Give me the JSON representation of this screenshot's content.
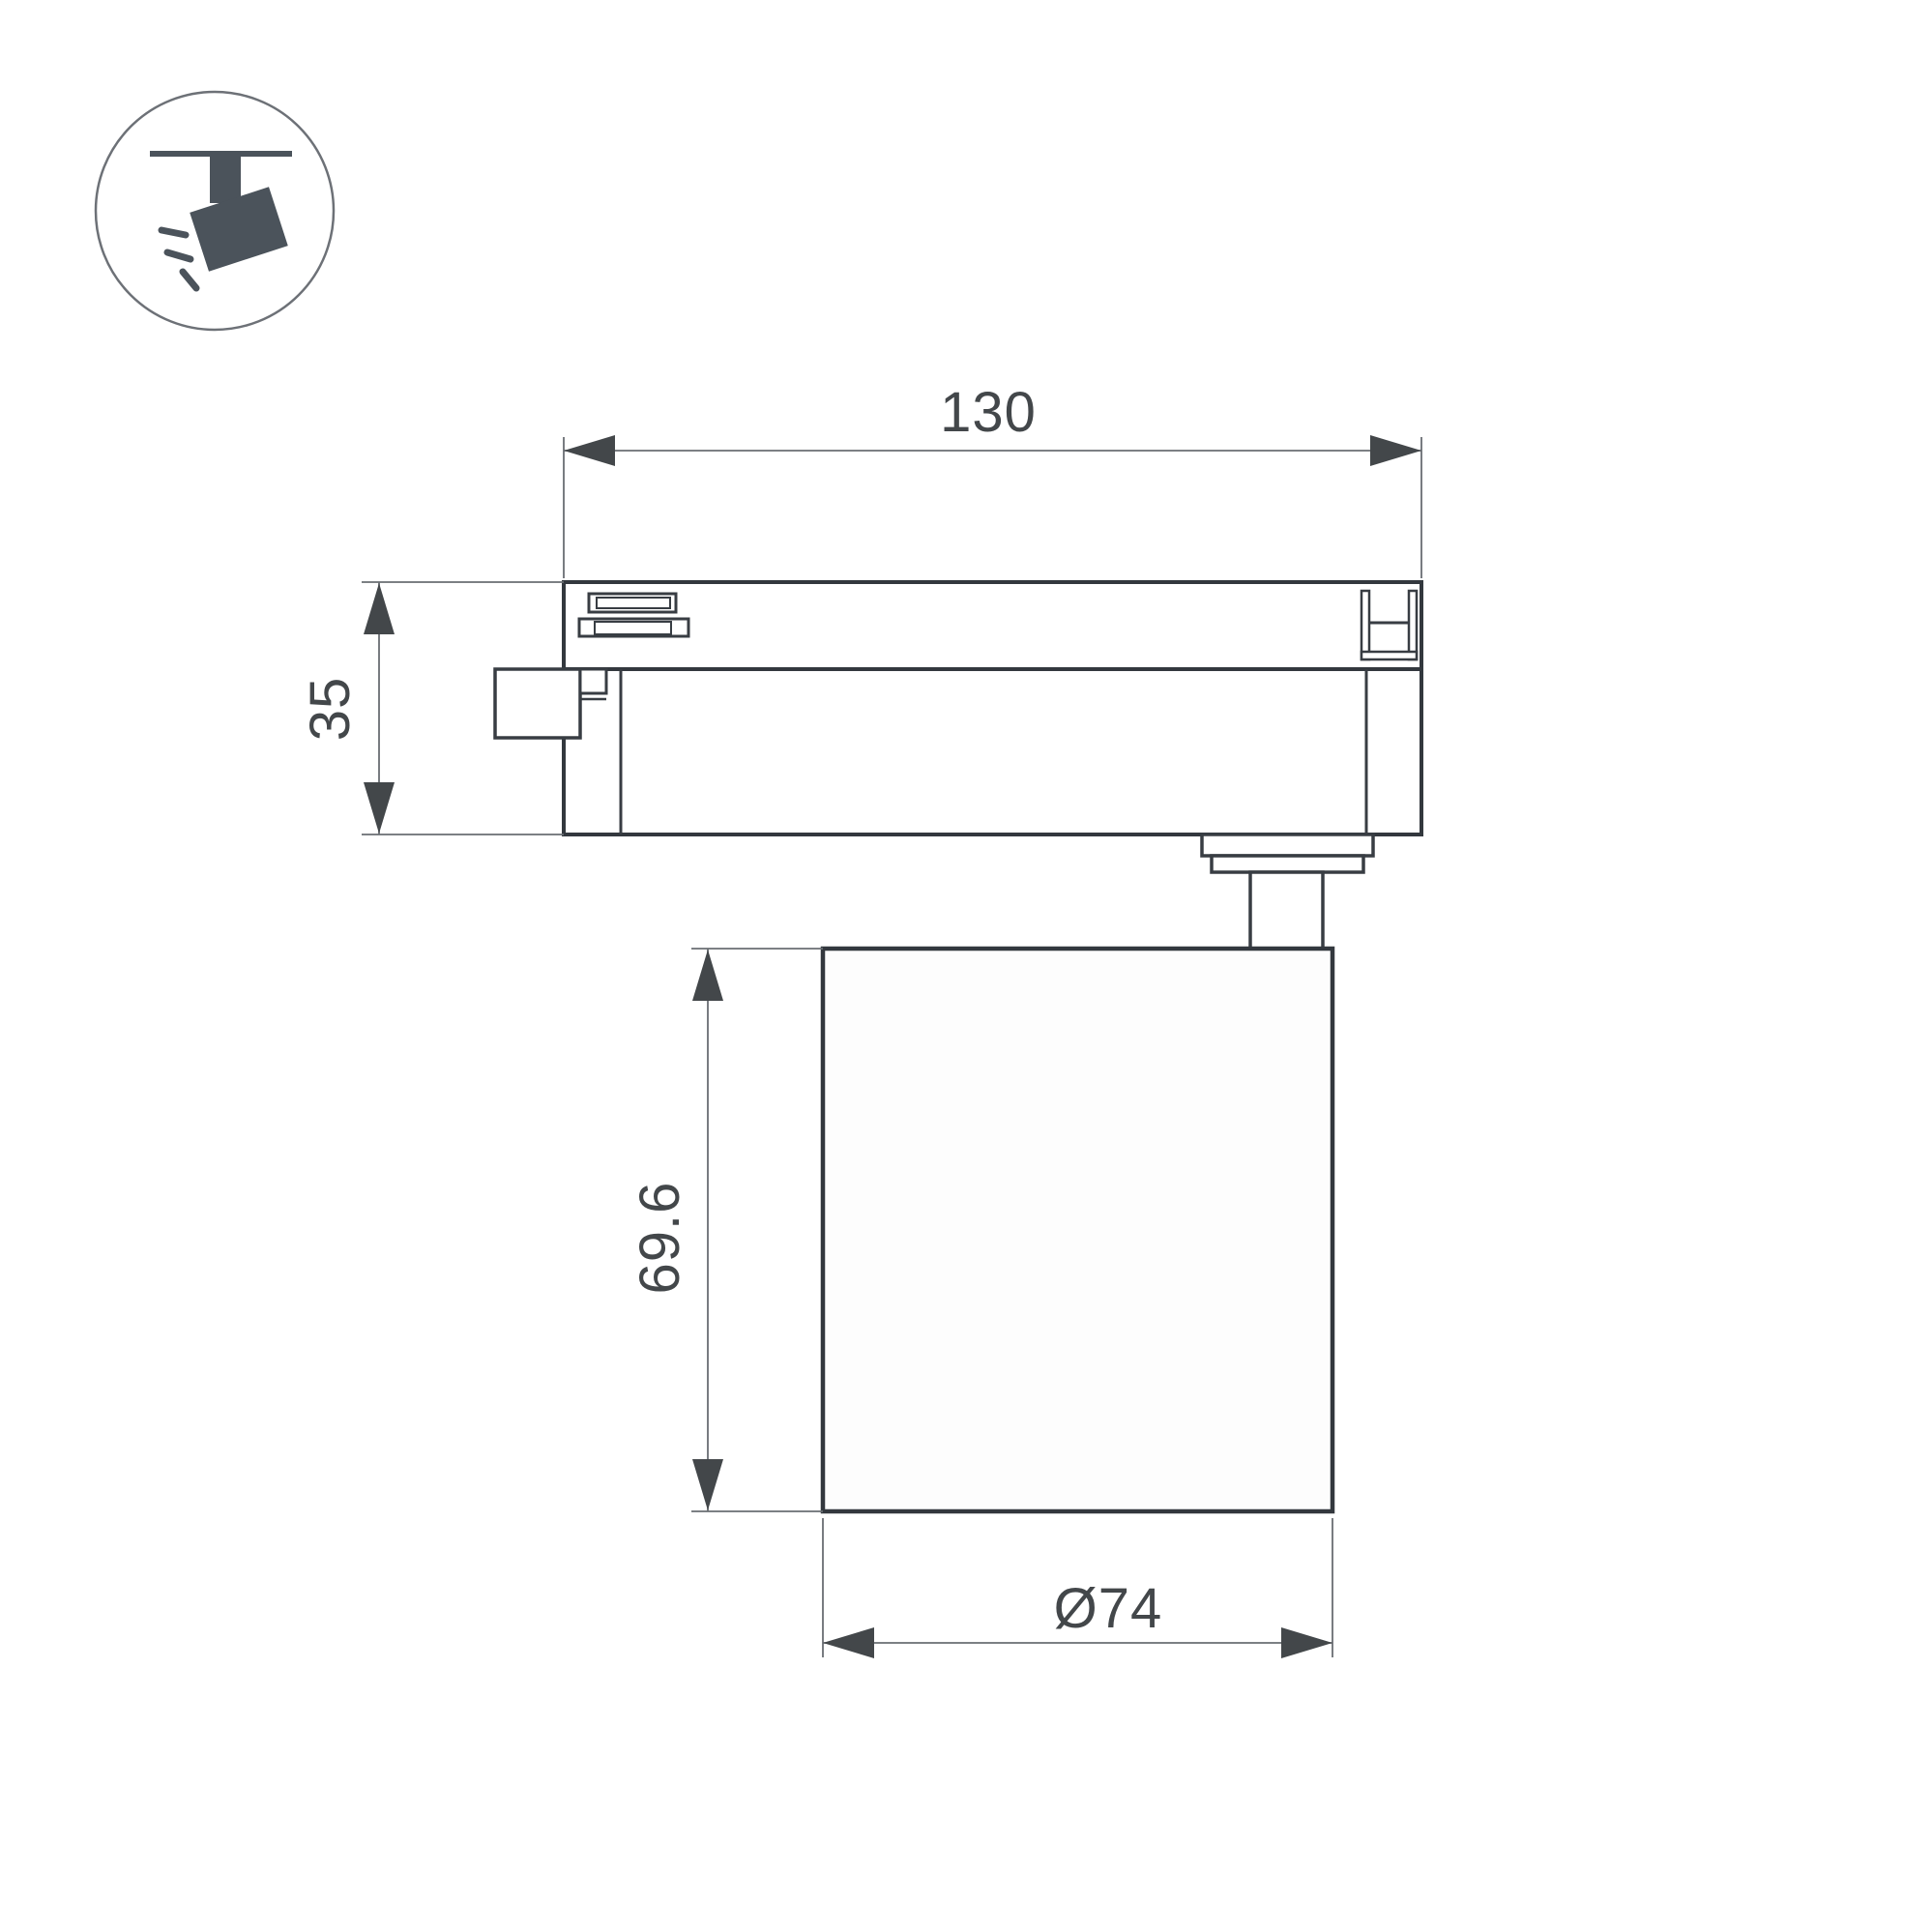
{
  "title": "track-spotlight-dimension-drawing",
  "icon": {
    "name": "track-spotlight-icon",
    "description": "ceiling track with tilted spotlight head and light rays"
  },
  "dimensions": {
    "track_width": "130",
    "adapter_height": "35",
    "body_height": "69.6",
    "body_diameter": "Ø74"
  },
  "colors": {
    "outline": "#33383e",
    "detail": "#383d43",
    "dimension_line": "#6a6e73",
    "dimension_text": "#43474a",
    "icon_fill": "#4b535b",
    "background": "#ffffff"
  }
}
